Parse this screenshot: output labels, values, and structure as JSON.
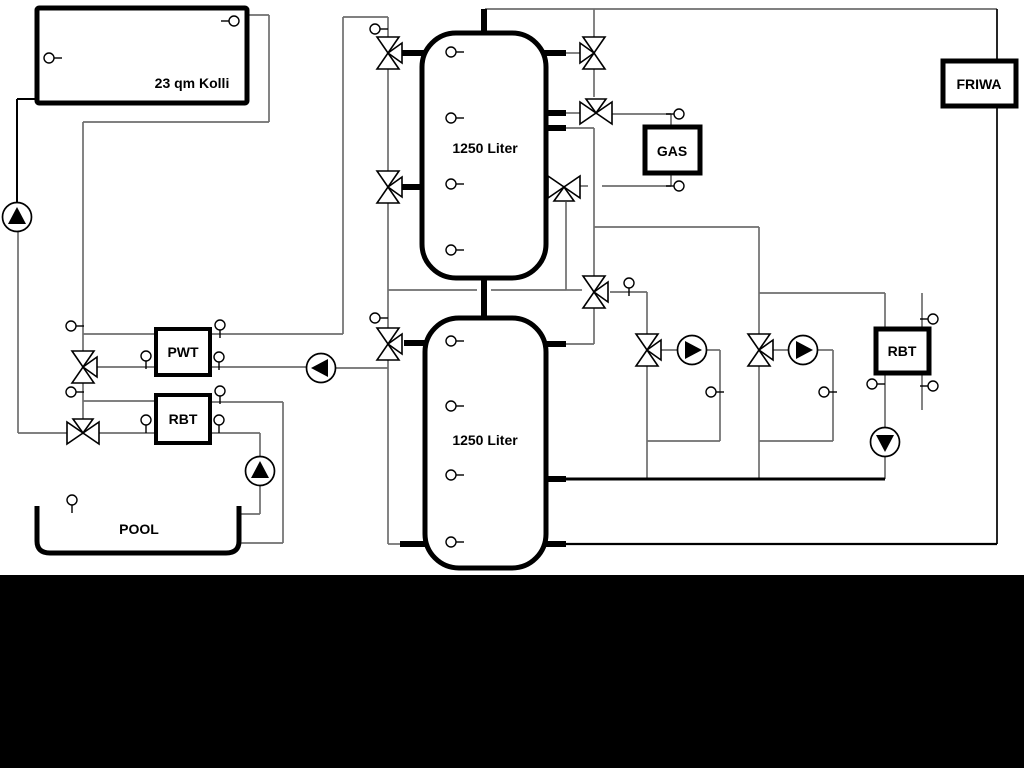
{
  "diagram": {
    "labels": {
      "solar_collector": "23 qm Kolli",
      "buffer_tank_1": "1250 Liter",
      "buffer_tank_2": "1250 Liter",
      "pwt": "PWT",
      "rbt_pool": "RBT",
      "gas_boiler": "GAS",
      "friwa": "FRIWA",
      "rbt_right": "RBT",
      "pool": "POOL"
    },
    "colors": {
      "pipe_gray": "#6e6e6e",
      "pipe_black": "#000000",
      "background": "#ffffff",
      "bottom_bar": "#000000",
      "symbol_fill": "#ffffff"
    }
  }
}
